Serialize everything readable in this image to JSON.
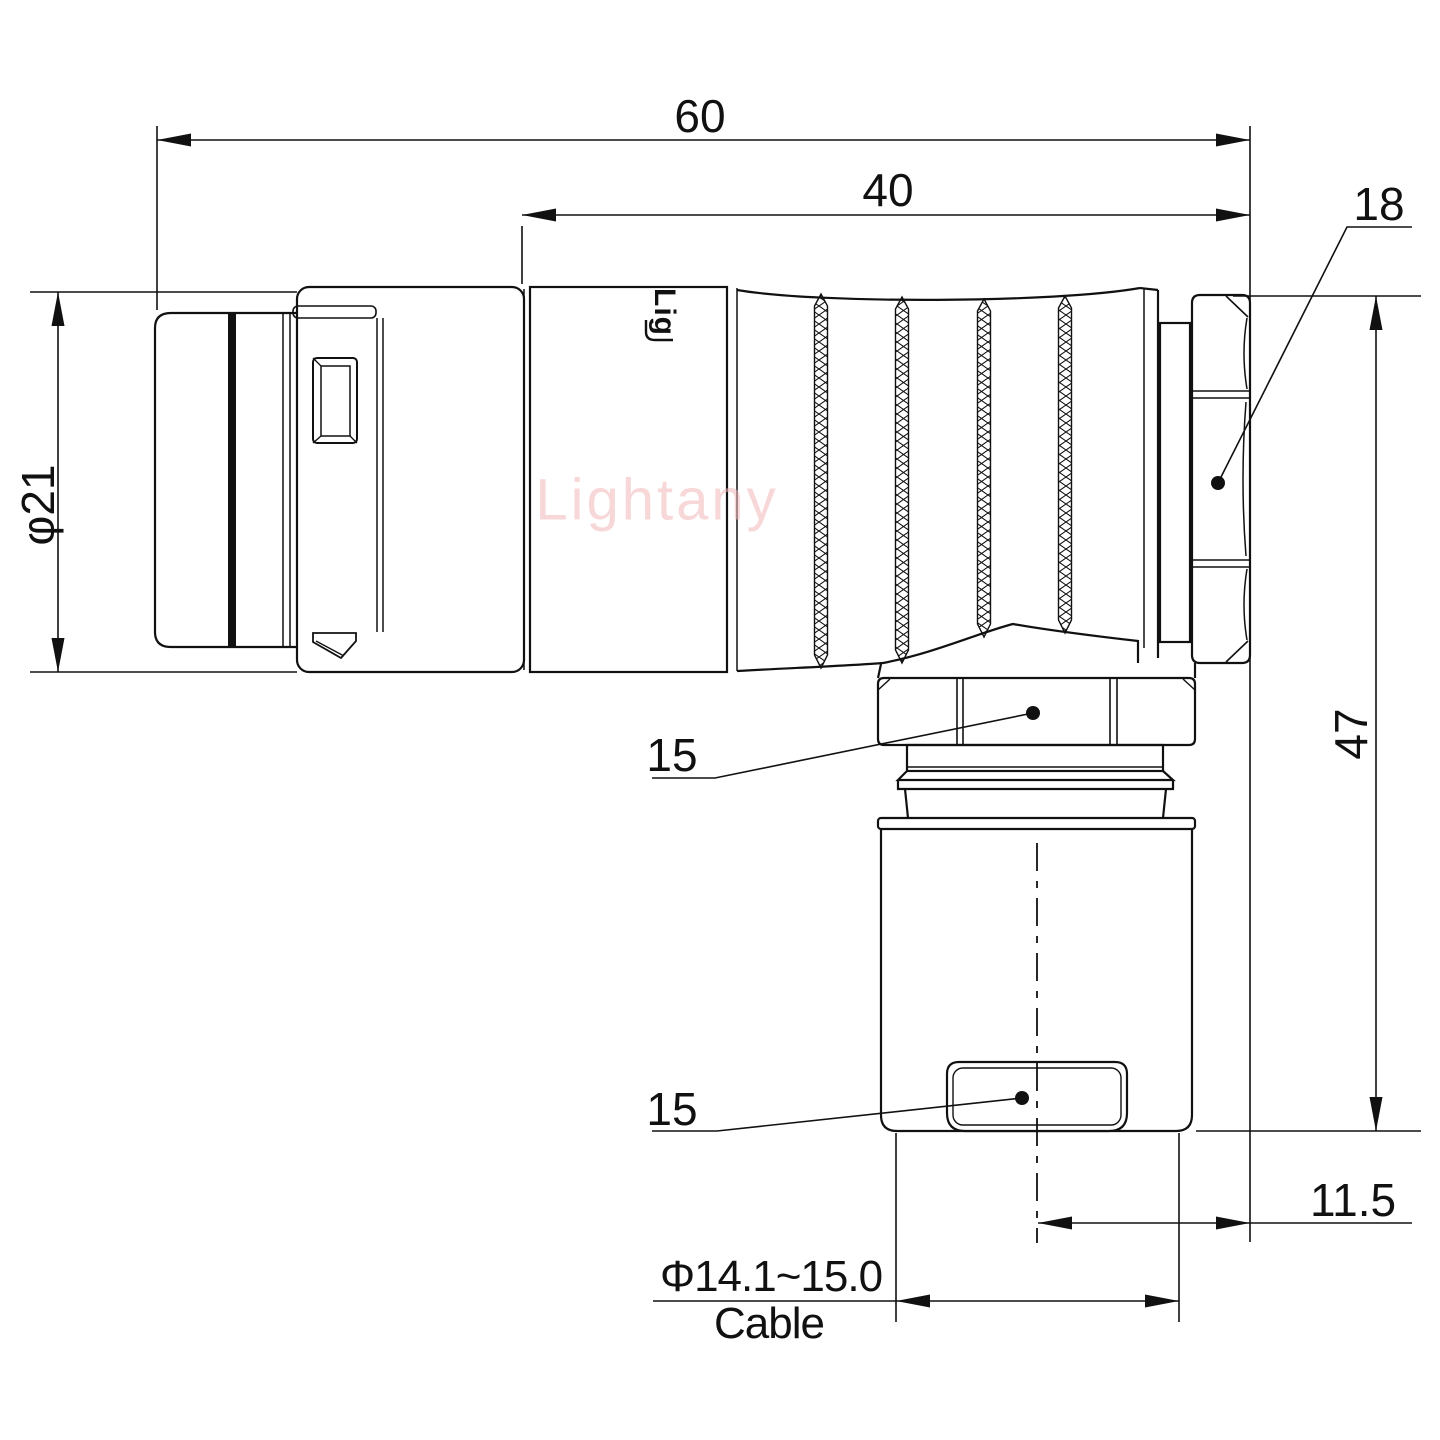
{
  "drawing": {
    "watermark": "Lightany",
    "engraving": "Lig",
    "line_color": "#111111",
    "watermark_color": "#f2b8b8",
    "dims": {
      "overall_length": "60",
      "rear_length": "40",
      "nut_flats": "18",
      "shell_dia": "φ21",
      "height": "47",
      "hex_top": "15",
      "hex_bottom": "15",
      "offset": "11.5",
      "cable_dia": "Φ14.1~15.0",
      "cable_word": "Cable"
    }
  }
}
